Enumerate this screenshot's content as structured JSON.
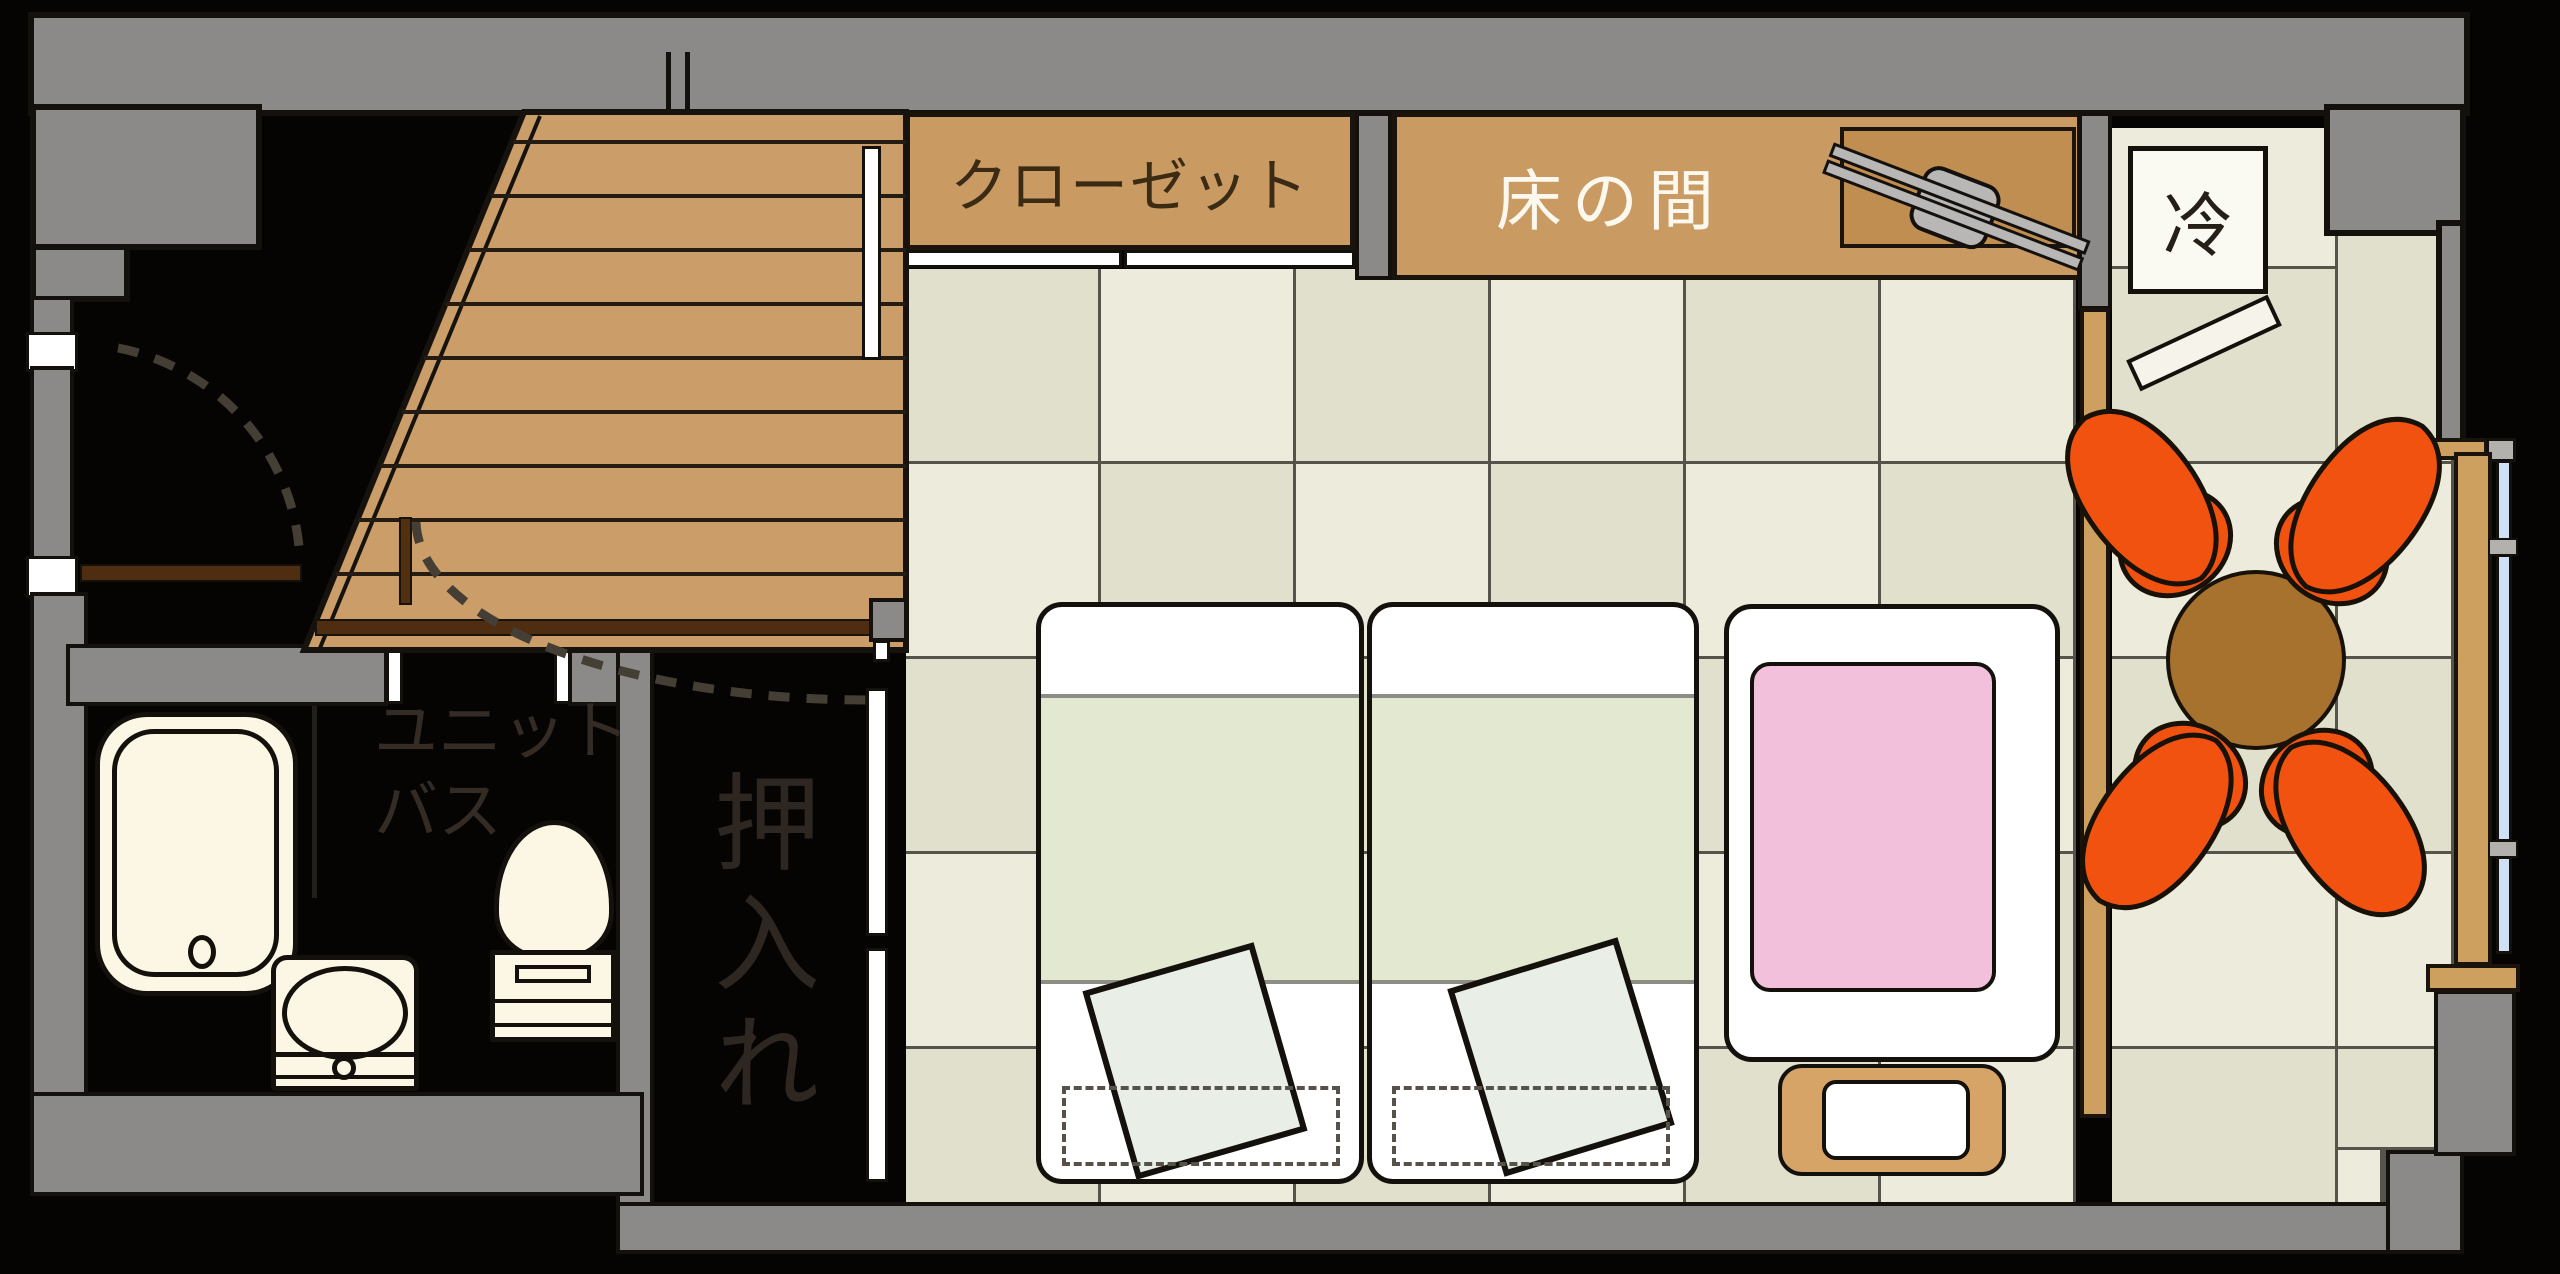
{
  "labels": {
    "closet": "クローゼット",
    "tokonoma": "床の間",
    "refrigerator": "冷",
    "oshiire": "押入れ",
    "unit_bath_line1": "ユニット",
    "unit_bath_line2": "バス"
  },
  "rooms": [
    {
      "name": "closet",
      "label": "クローゼット"
    },
    {
      "name": "tokonoma-alcove",
      "label": "床の間"
    },
    {
      "name": "refrigerator",
      "label": "冷"
    },
    {
      "name": "futon-closet",
      "label": "押入れ"
    },
    {
      "name": "unit-bath",
      "label": "ユニットバス"
    },
    {
      "name": "tatami-room",
      "label": ""
    },
    {
      "name": "engawa-veranda",
      "label": ""
    },
    {
      "name": "staircase",
      "label": ""
    }
  ],
  "palette": {
    "wall_gray": "#8c8a88",
    "outline_black": "#14100c",
    "tan_wood": "#c99b63",
    "stairs_wood": "#cb9e69",
    "shelf_wood": "#c18e51",
    "tatami_light": "#edebdc",
    "tatami_dark": "#e0e0cd",
    "tatami_line": "#55534a",
    "fixture_cream": "#fbf7e4",
    "chair_orange": "#f25210",
    "table_brown": "#a7722d",
    "kotatsu_pink": "#f2c0da",
    "blanket_green": "#e3e9d0",
    "cushion_green": "#e9efe6",
    "window_blue": "#cde0f4",
    "dark_brown": "#4f2d10",
    "label_dark_brown": "#3b2b15",
    "label_white": "#fcf8ed",
    "label_on_black": "#332c24"
  }
}
